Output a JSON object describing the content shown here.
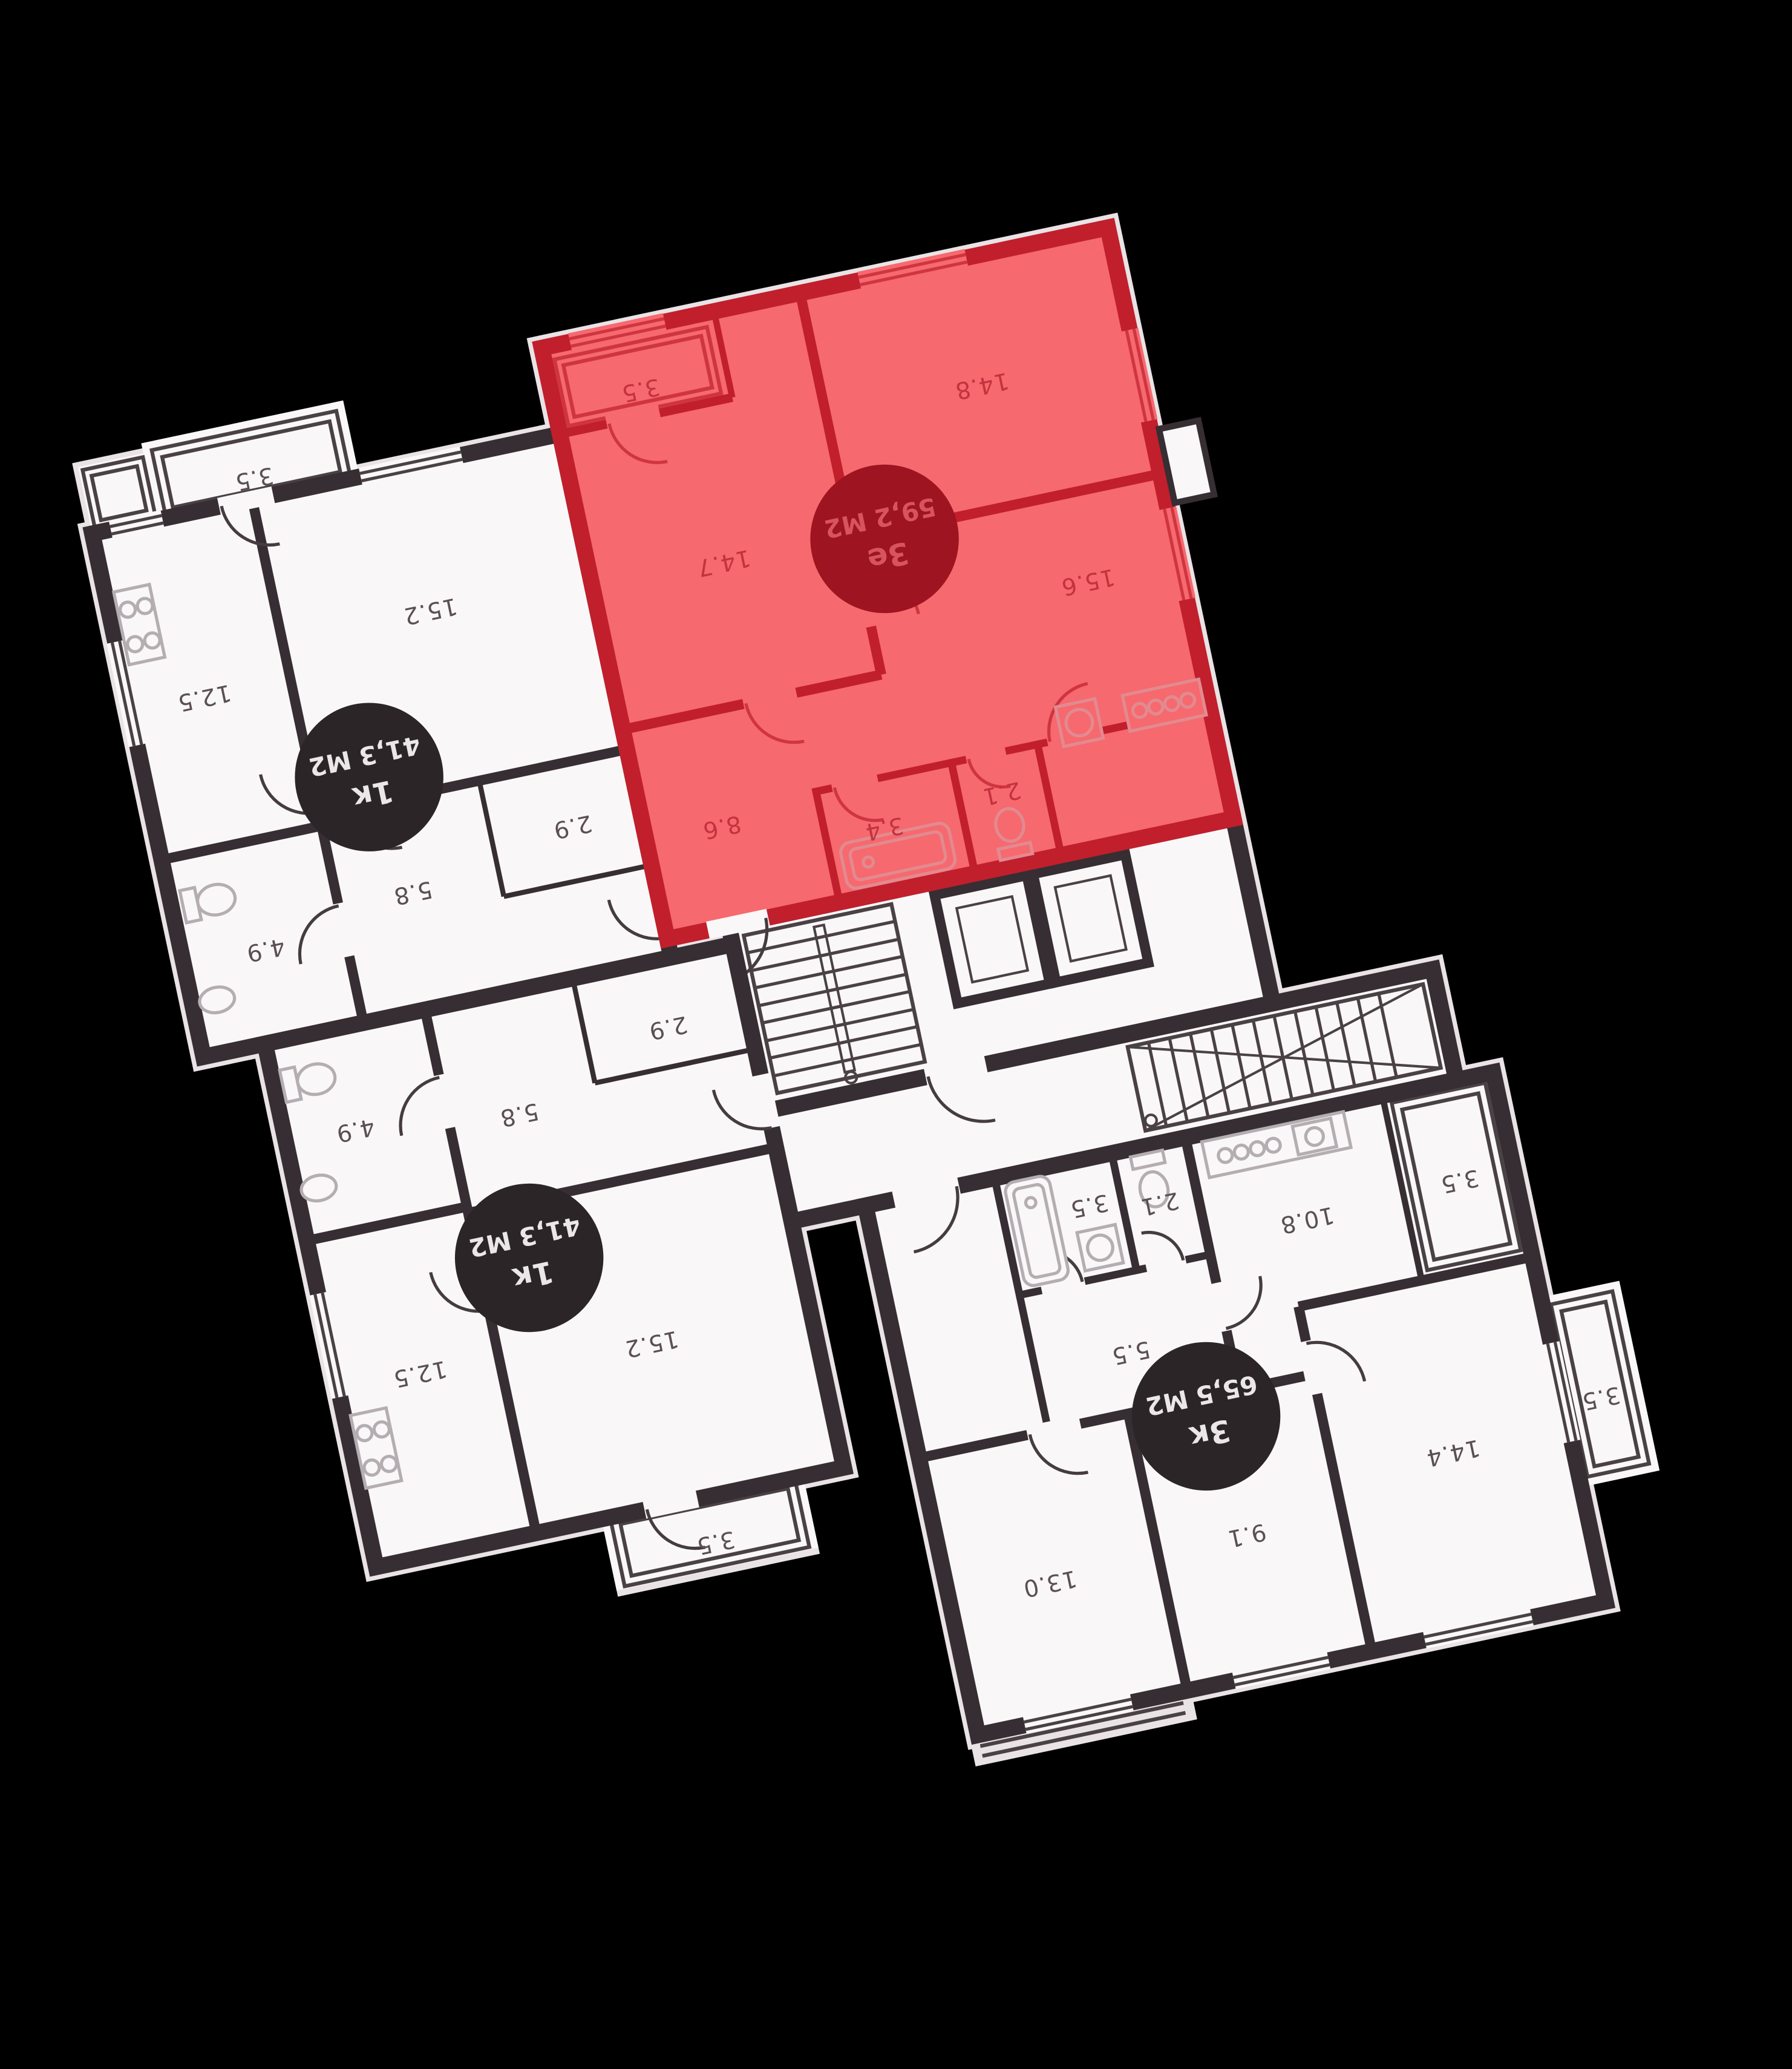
{
  "floorplan": {
    "background": "#000000",
    "colors": {
      "paper": "#faf7f8",
      "wall": "#362e32",
      "highlight_fill": "#f6696e",
      "highlight_wall": "#c11f2c",
      "highlight_badge": "#9e1420",
      "highlight_badge_text": "#d7545c",
      "badge": "#2b2528",
      "badge_text": "#ebe6e8",
      "room_label": "#5a4f54",
      "highlight_room_label": "#c2333e"
    },
    "apartments": [
      {
        "id": "1k-top",
        "type_label": "1к",
        "area_label": "41,3 М2",
        "highlighted": false,
        "rooms": [
          {
            "name": "balcony",
            "area": "3.5"
          },
          {
            "name": "living-room",
            "area": "15.2"
          },
          {
            "name": "kitchen",
            "area": "12.5"
          },
          {
            "name": "storage",
            "area": "2.9"
          },
          {
            "name": "hallway",
            "area": "5.8"
          },
          {
            "name": "bathroom",
            "area": "4.9"
          }
        ]
      },
      {
        "id": "3e-highlighted",
        "type_label": "3е",
        "area_label": "59,2 М2",
        "highlighted": true,
        "rooms": [
          {
            "name": "balcony",
            "area": "3.5"
          },
          {
            "name": "bedroom",
            "area": "14.8"
          },
          {
            "name": "bedroom",
            "area": "14.7"
          },
          {
            "name": "kitchen-living",
            "area": "15.6"
          },
          {
            "name": "hallway",
            "area": "8.6"
          },
          {
            "name": "bathroom",
            "area": "3.4"
          },
          {
            "name": "wc",
            "area": "2.1"
          }
        ]
      },
      {
        "id": "1k-middle",
        "type_label": "1к",
        "area_label": "41,3 М2",
        "highlighted": false,
        "rooms": [
          {
            "name": "storage",
            "area": "2.9"
          },
          {
            "name": "hallway",
            "area": "5.8"
          },
          {
            "name": "bathroom",
            "area": "4.9"
          },
          {
            "name": "living-room",
            "area": "15.2"
          },
          {
            "name": "kitchen",
            "area": "12.5"
          },
          {
            "name": "balcony",
            "area": "3.5"
          }
        ]
      },
      {
        "id": "3k-bottom",
        "type_label": "3к",
        "area_label": "65,5 М2",
        "highlighted": false,
        "rooms": [
          {
            "name": "kitchen",
            "area": "10.8"
          },
          {
            "name": "balcony",
            "area": "3.5"
          },
          {
            "name": "bathroom",
            "area": "3.5"
          },
          {
            "name": "wc",
            "area": "2.1"
          },
          {
            "name": "hallway",
            "area": "5.5"
          },
          {
            "name": "room",
            "area": "13.0"
          },
          {
            "name": "room",
            "area": "9.1"
          },
          {
            "name": "room",
            "area": "14.4"
          },
          {
            "name": "balcony",
            "area": "3.5"
          }
        ]
      }
    ]
  }
}
